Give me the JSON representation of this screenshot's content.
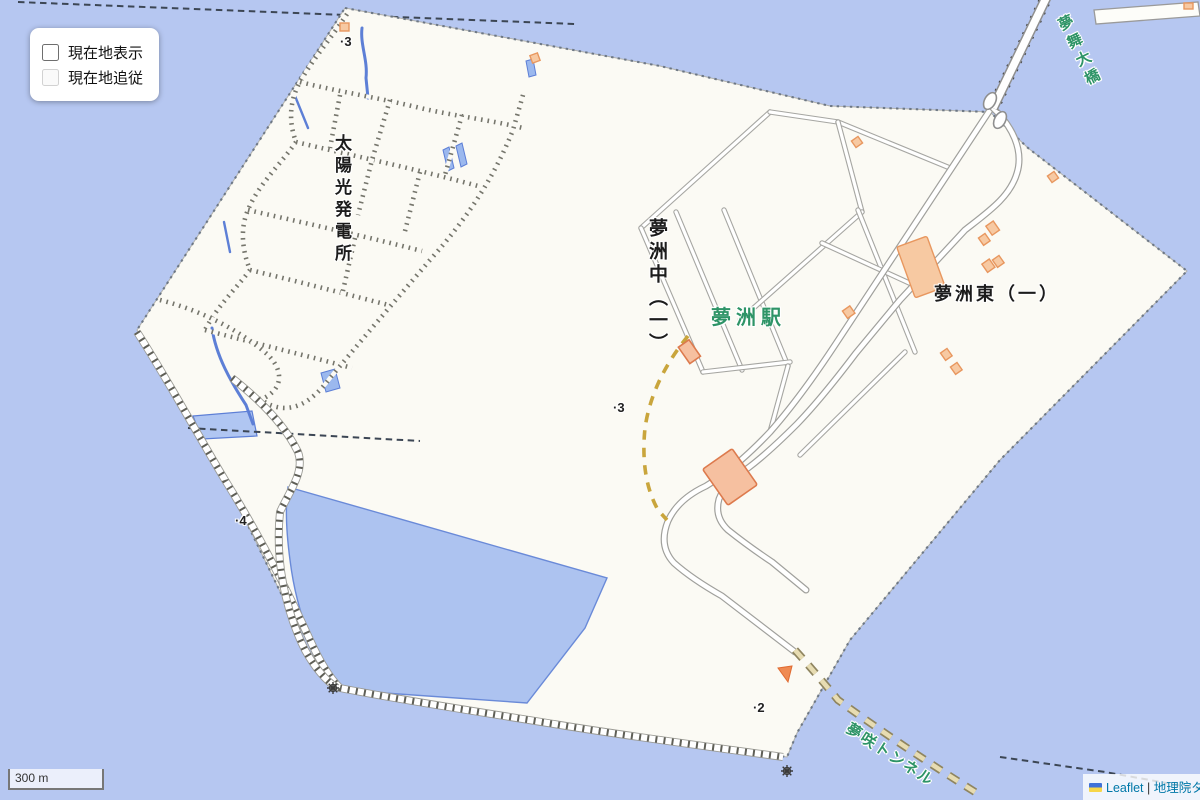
{
  "controls": {
    "location_panel": {
      "items": [
        {
          "label": "現在地表示",
          "checked": false,
          "enabled": true
        },
        {
          "label": "現在地追従",
          "checked": false,
          "enabled": false
        }
      ]
    },
    "scale": {
      "label": "300 m"
    },
    "attribution": {
      "flag_icon": "ukraine-flag",
      "leaflet_label": "Leaflet",
      "separator": " | ",
      "tiles_label": "地理院タイル"
    }
  },
  "map": {
    "labels": {
      "solar_plant": "太陽光発電所",
      "district_naka": "夢洲中（一）",
      "station": "夢洲駅",
      "district_higashi": "夢洲東（一）",
      "bridge": "夢舞大橋",
      "tunnel": "夢咲トンネル"
    },
    "spots": [
      {
        "text": "·3"
      },
      {
        "text": "·3"
      },
      {
        "text": "·4"
      },
      {
        "text": "·2"
      }
    ],
    "colors": {
      "sea": "#b6c7f1",
      "land": "#fbfaf4",
      "pond": "#adc3f0",
      "pond_outline": "#6a8ad8",
      "road_fill": "#ffffff",
      "road_casing": "#a6a6a2",
      "building_fill": "#f7c9a2",
      "building_outline": "#e8975f",
      "label_green": "#2e9467",
      "rail_dash_yellow": "#c9a53c",
      "tunnel_dash": "#b3a476",
      "link_blue": "#0078a8"
    }
  }
}
